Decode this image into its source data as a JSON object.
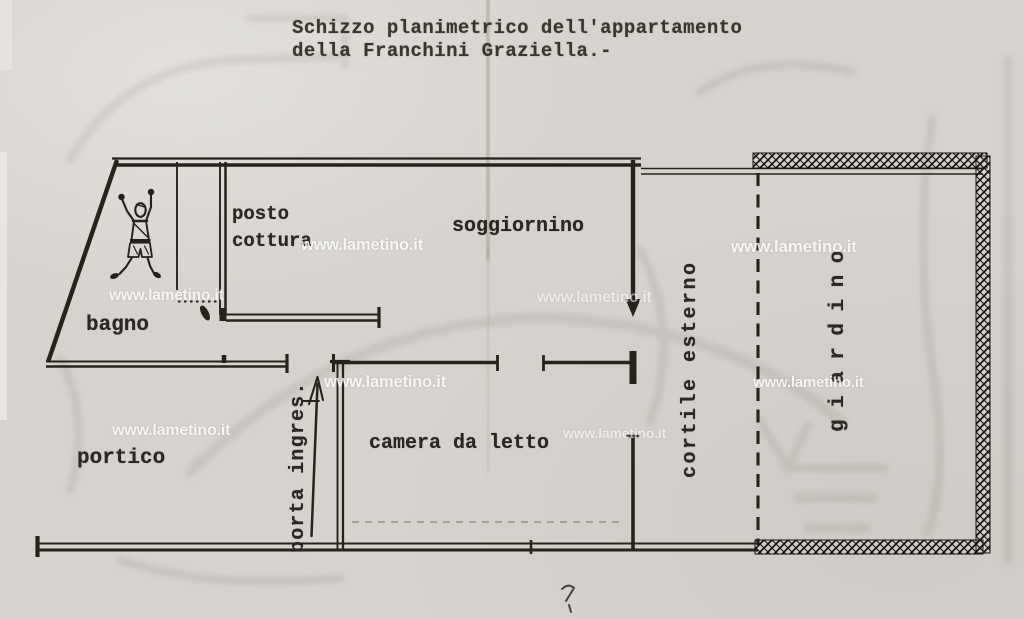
{
  "title": {
    "line1": "Schizzo planimetrico dell'appartamento",
    "line2": "della Franchini Graziella.-"
  },
  "rooms": {
    "bagno": "bagno",
    "posto_cottura_line1": "posto",
    "posto_cottura_line2": "cottura",
    "soggiornino": "soggiornino",
    "portico": "portico",
    "camera_da_letto": "camera da letto",
    "porta_ingresso": "porta ingres.",
    "cortile_esterno": "cortile esterno",
    "giardino": "giardino"
  },
  "watermark": {
    "text": "www.lametino.it"
  },
  "colors": {
    "paper": "#d6d3cf",
    "ink": "#26221c",
    "watermark": "#ffffff"
  }
}
